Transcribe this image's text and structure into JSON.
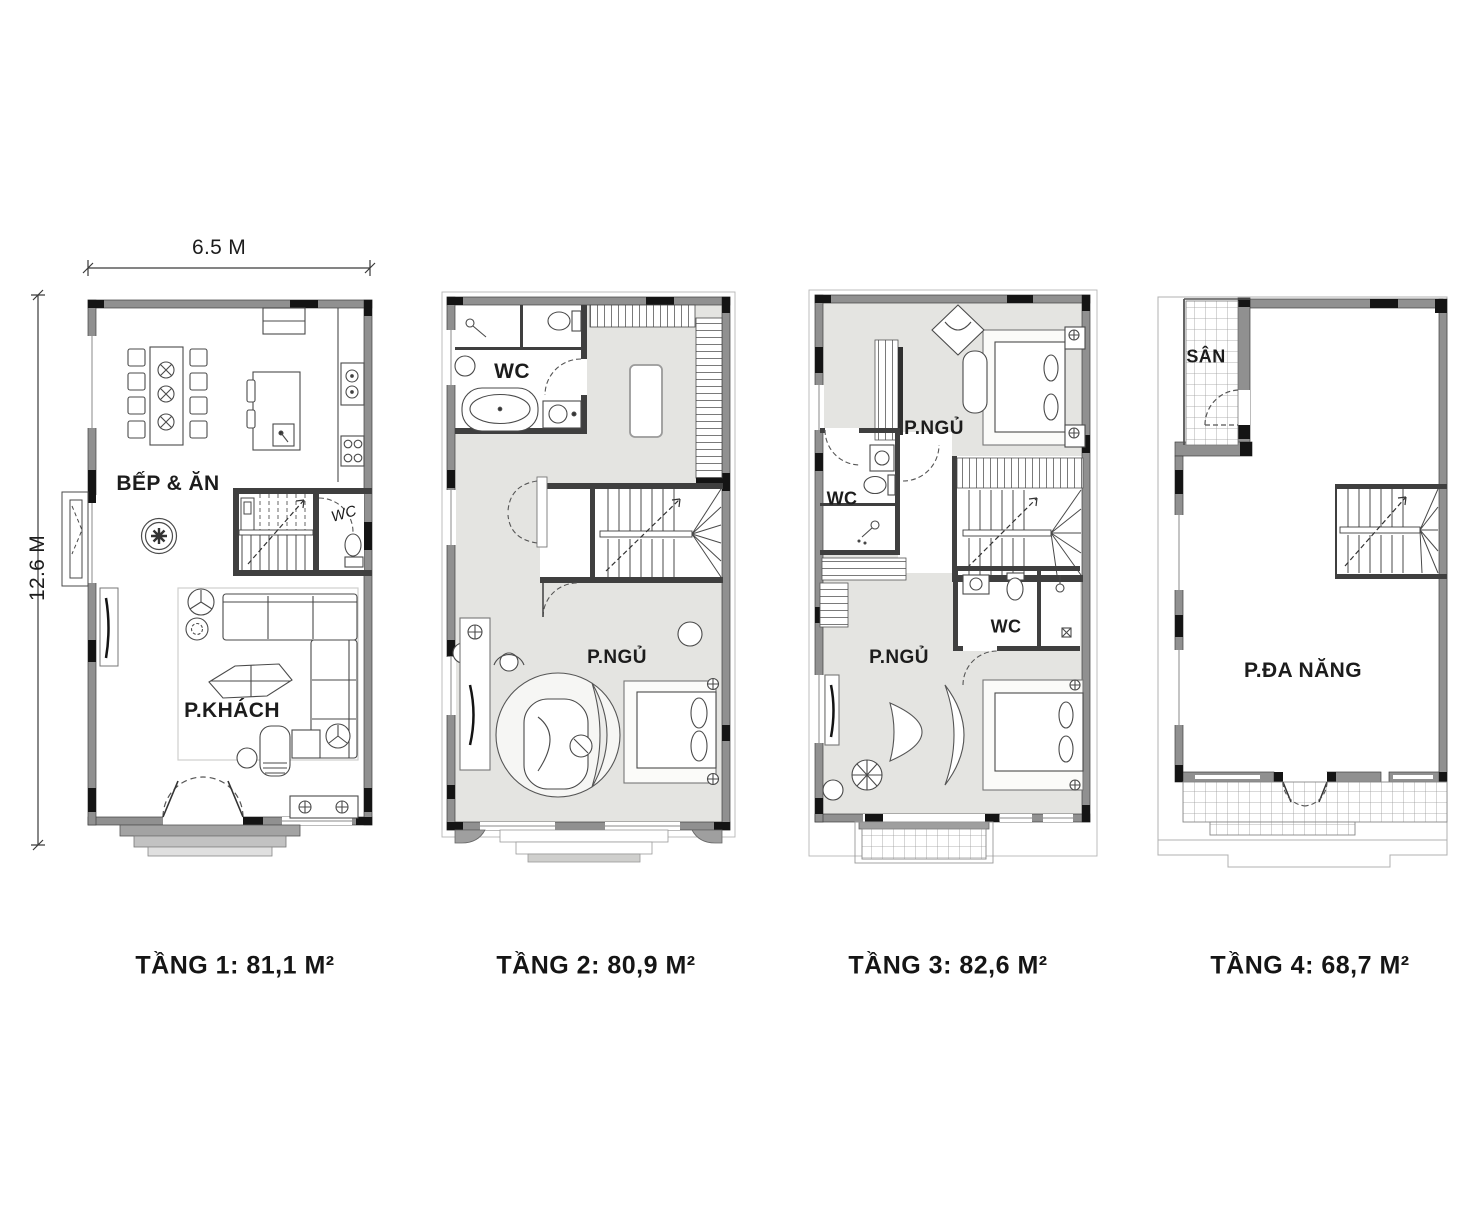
{
  "page": {
    "background": "#ffffff"
  },
  "dimensions": {
    "width_label": "6.5 M",
    "height_label": "12.6 M"
  },
  "floors": [
    {
      "caption": "TẦNG 1: 81,1 M²",
      "labels": {
        "kitchen_dining": "BẾP & ĂN",
        "wc": "WC",
        "living": "P.KHÁCH"
      }
    },
    {
      "caption": "TẦNG 2: 80,9 M²",
      "labels": {
        "wc": "WC",
        "bedroom": "P.NGỦ"
      }
    },
    {
      "caption": "TẦNG 3: 82,6 M²",
      "labels": {
        "bedroom_top": "P.NGỦ",
        "wc_left": "WC",
        "wc_right": "WC",
        "bedroom_bottom": "P.NGỦ"
      }
    },
    {
      "caption": "TẦNG 4: 68,7 M²",
      "labels": {
        "terrace": "SÂN",
        "multipurpose": "P.ĐA NĂNG"
      }
    }
  ],
  "colors": {
    "wall": "#909090",
    "wall_dark": "#3f3f3f",
    "column": "#141414",
    "floor_shade": "#e4e4e1",
    "line": "#4a4a4a",
    "background": "#ffffff"
  }
}
